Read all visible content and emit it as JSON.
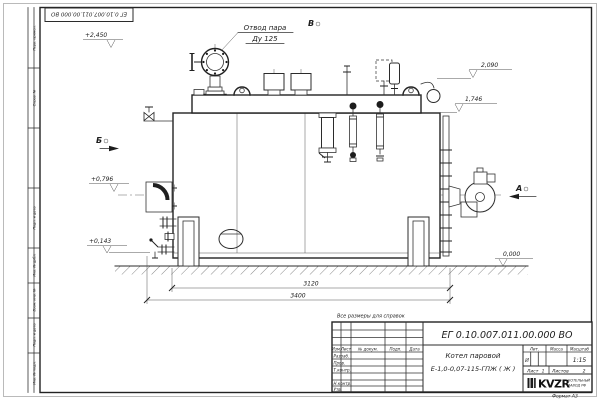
{
  "frame": {
    "stamp_number": "ЕГ 0.10.007.011.00.000  ВО",
    "format_label": "Формат А3",
    "margin_labels": {
      "m1": "Перв. примен.",
      "m2": "Справ. №",
      "m3": "Подп. и дата",
      "m4": "Инв. № дубл.",
      "m5": "Взам. инв. №",
      "m6": "Подп. и дата",
      "m7": "Инв. № подл."
    }
  },
  "annotations": {
    "steam_outlet": {
      "line1": "Отвод пара",
      "line2": "Ду 125"
    },
    "views": {
      "a": "А",
      "b": "Б",
      "v": "В"
    },
    "elevations": {
      "top_valve": "+2,450",
      "fittings_top": "2,090",
      "body_top": "1,746",
      "burner_axis": "+0,796",
      "drain": "+0,143",
      "ground": "0,000"
    },
    "dimensions": {
      "support_span": "3120",
      "overall_length": "3400"
    },
    "note": "Все размеры для справок"
  },
  "title_block": {
    "doc_number": "ЕГ 0.10.007.011.00.000  ВО",
    "product_name_line1": "Котел паровой",
    "product_name_line2": "Е-1,0-0,07-115-ГПЖ ( Ж )",
    "columns": {
      "izm": "Изм.",
      "list": "Лист",
      "doc": "№ докум.",
      "podp": "Подп.",
      "data": "Дата"
    },
    "rows": {
      "razrab": "Разраб.",
      "prov": "Пров.",
      "tkontr": "Т.контр.",
      "nkontr": "Н.контр.",
      "utv": "Утв."
    },
    "right": {
      "lit_header": "Лит.",
      "mass_header": "Масса",
      "scale_header": "Масштаб",
      "lit_value": "И",
      "scale_value": "1:15",
      "sheet_label": "Лист",
      "sheet_value": "1",
      "sheets_label": "Листов",
      "sheets_value": "2"
    },
    "logo": {
      "text": "KVZR",
      "sub1": "КОТЕЛЬНЫЙ",
      "sub2": "ЗАВОД РФ"
    }
  }
}
